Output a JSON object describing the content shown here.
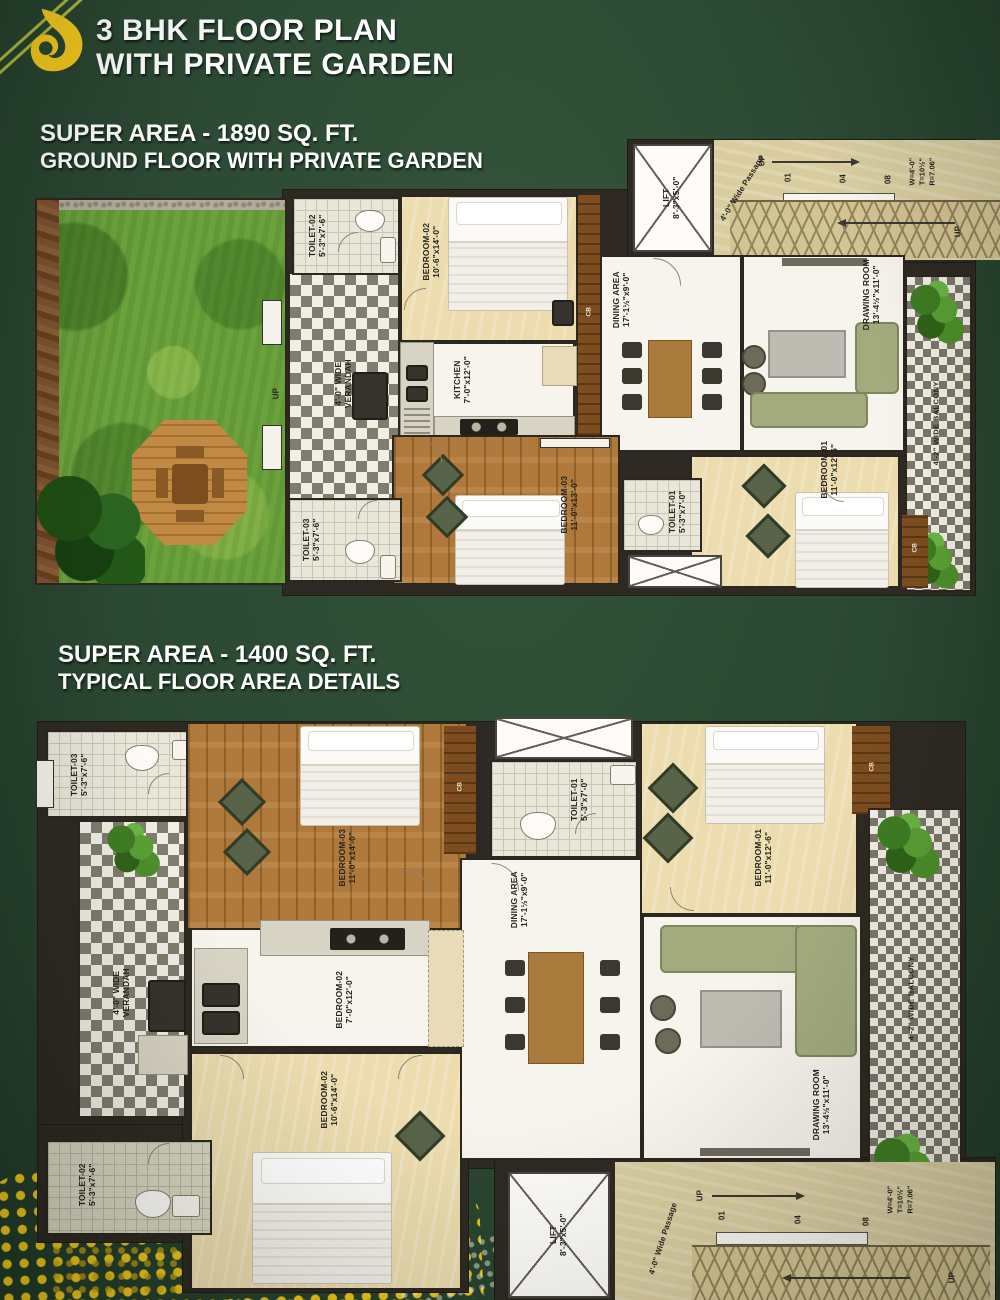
{
  "page": {
    "title_line1": "3 BHK FLOOR PLAN",
    "title_line2": "WITH PRIVATE GARDEN",
    "logo": "flame-logo",
    "colors": {
      "background": "#2b4832",
      "accent_yellow": "#f2c81e",
      "heading_text": "#ffffff"
    }
  },
  "plan1": {
    "heading_line1": "SUPER AREA - 1890 SQ. FT.",
    "heading_line2": "GROUND FLOOR WITH PRIVATE GARDEN",
    "rooms": {
      "toilet2": {
        "name": "TOILET-02",
        "dims": "5'-3\"x7'-6\""
      },
      "bedroom2": {
        "name": "BEDROOM-02",
        "dims": "10'-6\"x14'-0\""
      },
      "kitchen": {
        "name": "KITCHEN",
        "dims": "7'-0\"x12'-0\""
      },
      "dining": {
        "name": "DINING AREA",
        "dims": "17'-1½\"x9'-0\""
      },
      "drawing": {
        "name": "DRAWING ROOM",
        "dims": "13'-4½\"x11'-0\""
      },
      "bedroom1": {
        "name": "BEDROOM-01",
        "dims": "11'-0\"x12'-6\""
      },
      "toilet1": {
        "name": "TOILET-01",
        "dims": "5'-3\"x7'-0\""
      },
      "bedroom3": {
        "name": "BEDROOM-03",
        "dims": "11'-0\"x13'-0\""
      },
      "toilet3": {
        "name": "TOILET-03",
        "dims": "5'-3\"x7'-6\""
      },
      "lift": {
        "name": "LIFT",
        "dims": "8'-3\"x5'-0\""
      }
    },
    "labels": {
      "verandah": "4'-0\" WIDE VERANDAH",
      "balcony": "4'-2\" WIDE BALCONY",
      "passage": "4'-0\" Wide Passage",
      "up": "UP",
      "cb": "CB",
      "stair_n1": "01",
      "stair_n2": "04",
      "stair_n3": "08",
      "stair_w": "W=4'-0\"",
      "stair_t": "T=10½\"",
      "stair_r": "R=7.06\""
    }
  },
  "plan2": {
    "heading_line1": "SUPER AREA - 1400 SQ. FT.",
    "heading_line2": "TYPICAL FLOOR AREA DETAILS",
    "rooms": {
      "toilet3": {
        "name": "TOILET-03",
        "dims": "5'-3\"x7'-6\""
      },
      "bedroom3": {
        "name": "BEDROOM-03",
        "dims": "11'-0\"x14'-0\""
      },
      "toilet1": {
        "name": "TOILET-01",
        "dims": "5'-3\"x7'-0\""
      },
      "bedroom1": {
        "name": "BEDROOM-01",
        "dims": "11'-0\"x12'-6\""
      },
      "dining": {
        "name": "DINING AREA",
        "dims": "17'-1½\"x9'-0\""
      },
      "kitchen_area": {
        "name": "BEDROOM-02",
        "dims": "7'-0\"x12'-0\""
      },
      "bedroom2": {
        "name": "BEDROOM-02",
        "dims": "10'-6\"x14'-0\""
      },
      "drawing": {
        "name": "DRAWING ROOM",
        "dims": "13'-4½\"x11'-0\""
      },
      "toilet2": {
        "name": "TOILET-02",
        "dims": "5'-3\"x7'-6\""
      },
      "lift": {
        "name": "LIFT",
        "dims": "8'-3\"x5'-0\""
      }
    },
    "labels": {
      "verandah": "4'-0\" WIDE VERANDAH",
      "balcony": "4'-2\" WIDE BALCONY",
      "passage": "4'-0\" Wide Passage",
      "up": "UP",
      "cb": "CB",
      "stair_n1": "01",
      "stair_n2": "04",
      "stair_n3": "08",
      "stair_w": "W=4'-0\"",
      "stair_t": "T=10½\"",
      "stair_r": "R=7.06\""
    }
  }
}
